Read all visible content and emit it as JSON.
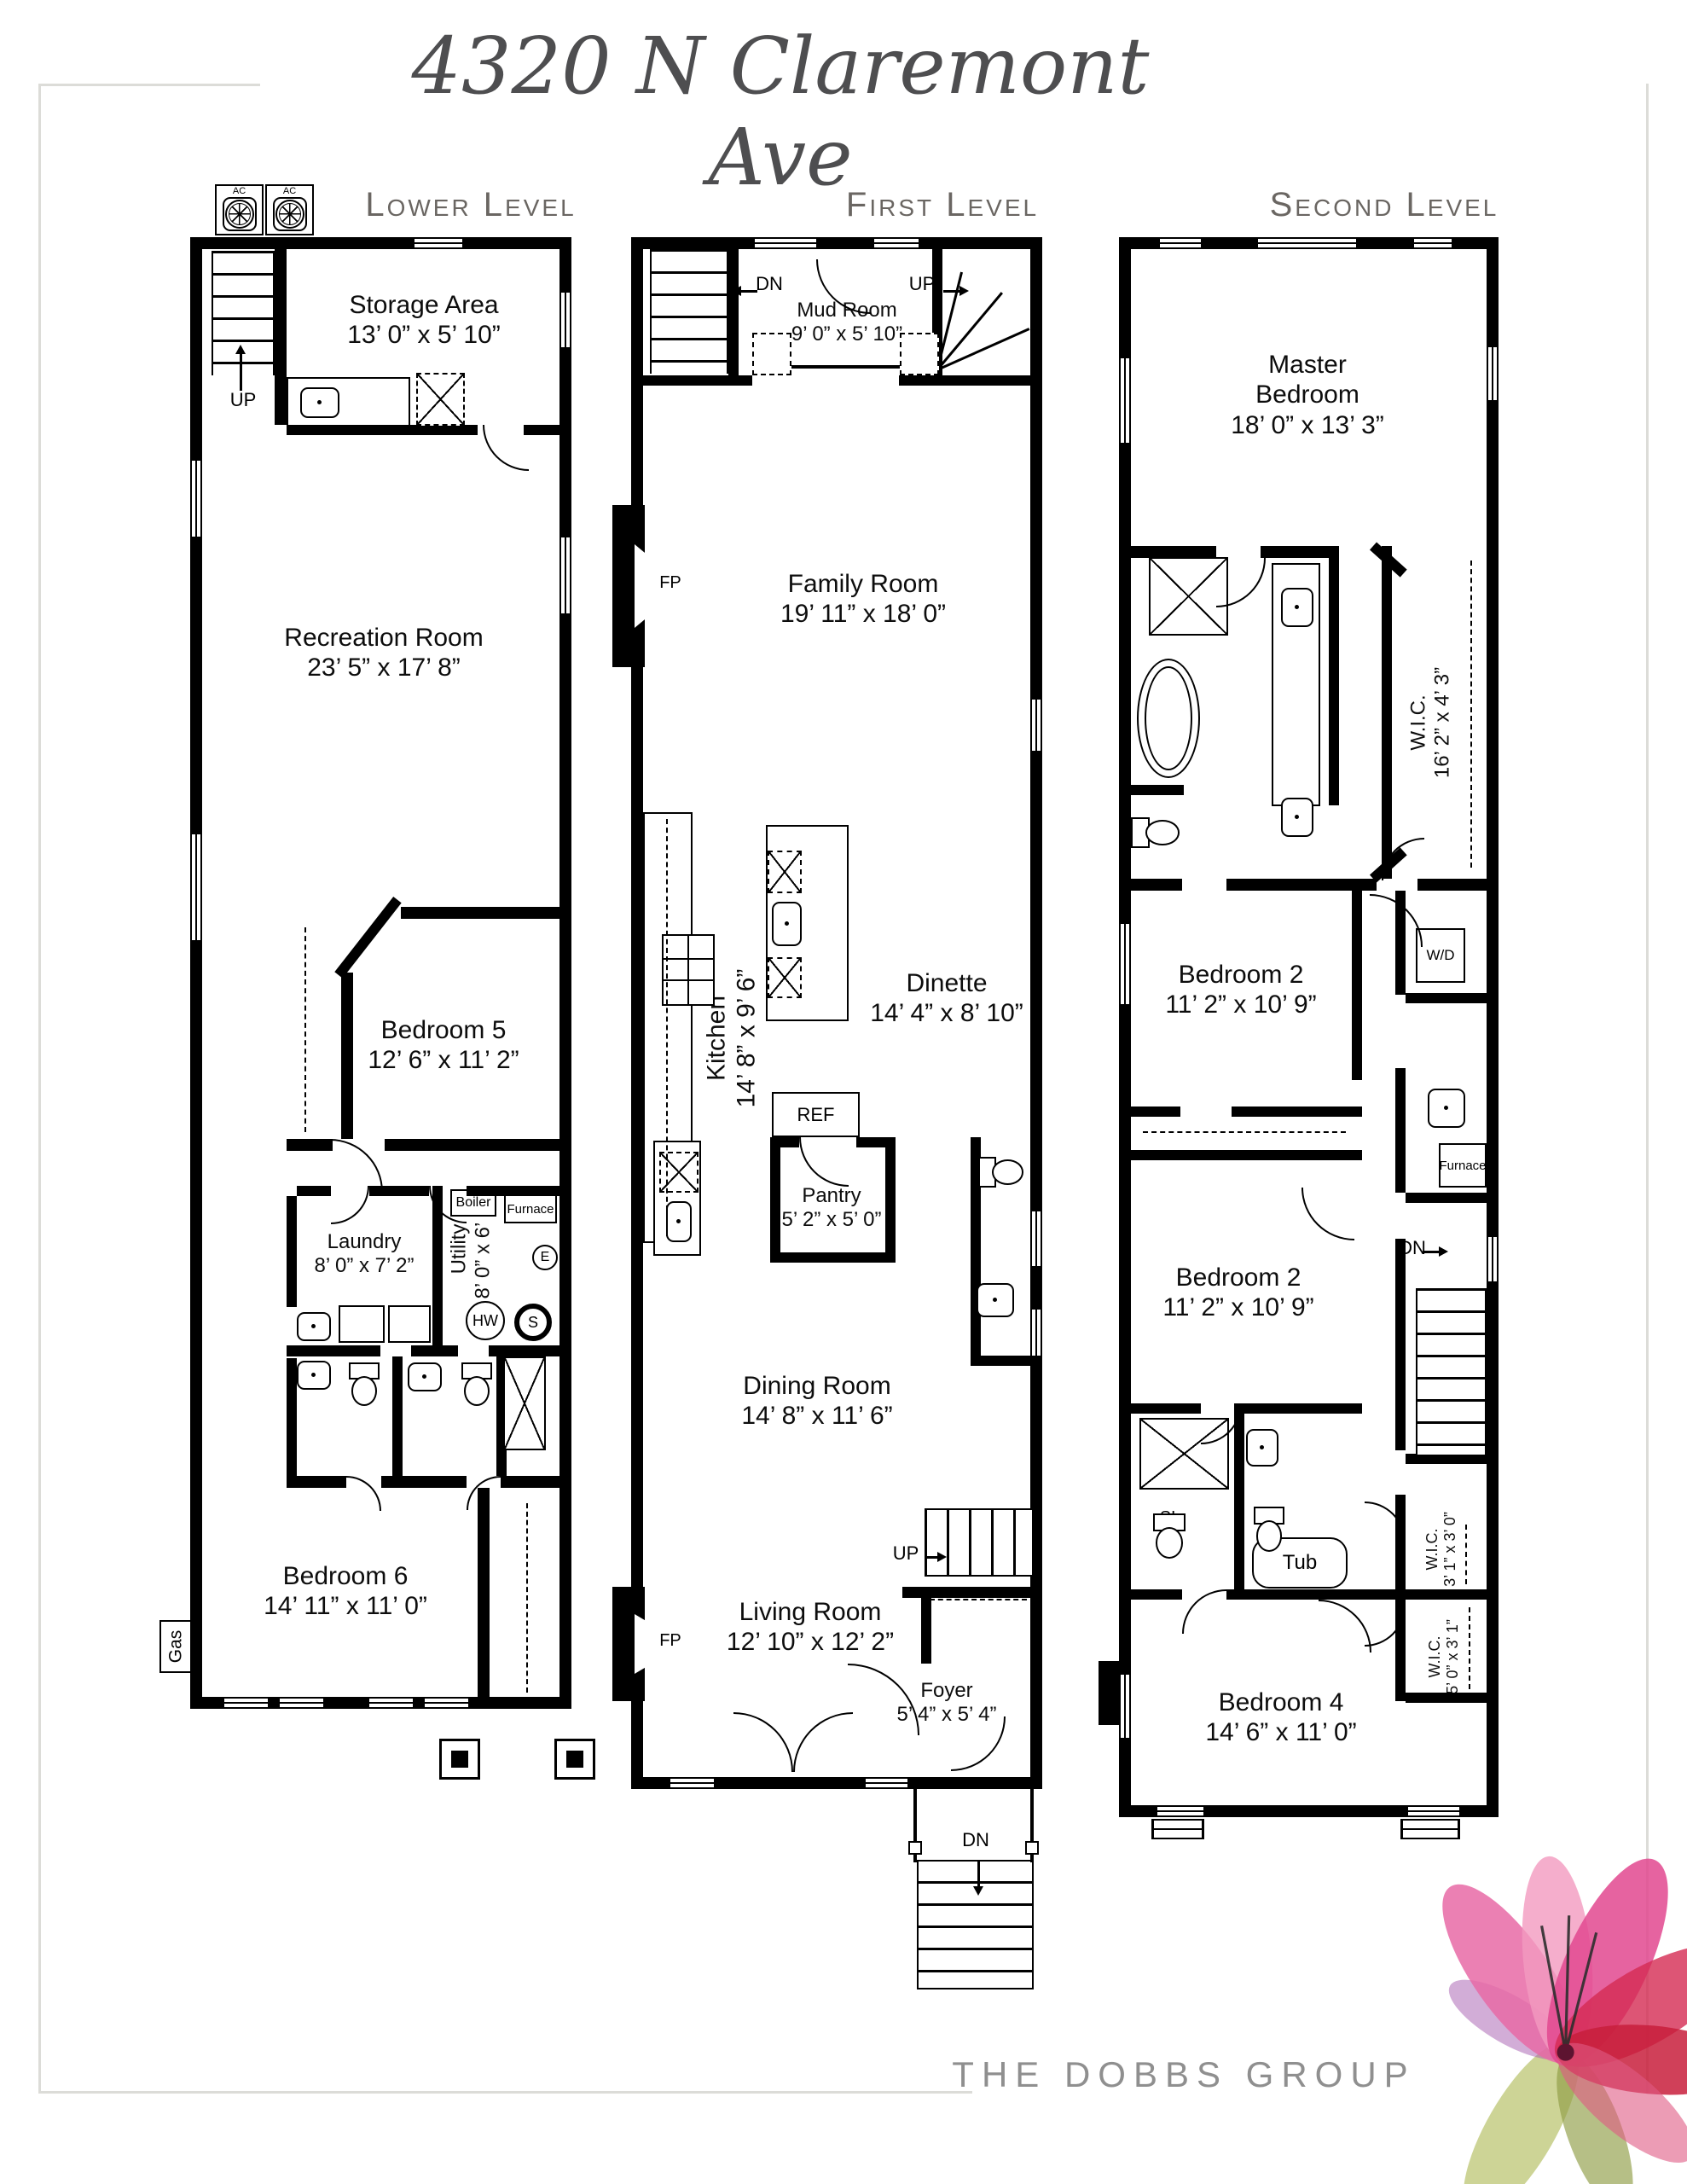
{
  "page": {
    "title": "4320 N Claremont Ave",
    "brand": "THE DOBBS GROUP"
  },
  "headers": {
    "lower": "Lower Level",
    "first": "First Level",
    "second": "Second Level"
  },
  "labels": {
    "up": "UP",
    "dn": "DN",
    "fp": "FP",
    "ref": "REF",
    "dish": "DISH",
    "mw": "MW",
    "wine": "WINE",
    "cooler": "COOLER",
    "ac": "AC",
    "gas": "Gas",
    "boiler": "Boiler",
    "furnace": "Furnace",
    "e": "E",
    "hw": "HW",
    "s": "S",
    "wd": "W/D",
    "sl": "SL",
    "tub": "Tub"
  },
  "lower": {
    "storage": {
      "name": "Storage Area",
      "dims": "13’ 0” x 5’ 10”"
    },
    "recreation": {
      "name": "Recreation Room",
      "dims": "23’ 5” x 17’ 8”"
    },
    "bedroom5": {
      "name": "Bedroom 5",
      "dims": "12’ 6” x 11’ 2”"
    },
    "laundry": {
      "name": "Laundry",
      "dims": "8’ 0” x 7’ 2”"
    },
    "utility": {
      "name": "Utility",
      "dims": "8’ 0” x 6’ 0”"
    },
    "bedroom6": {
      "name": "Bedroom 6",
      "dims": "14’ 11” x 11’ 0”"
    }
  },
  "first": {
    "mud": {
      "name": "Mud Room",
      "dims": "9’ 0” x 5’ 10”"
    },
    "family": {
      "name": "Family Room",
      "dims": "19’ 11” x 18’ 0”"
    },
    "kitchen": {
      "name": "Kitchen",
      "dims": "14’ 8” x 9’ 6”"
    },
    "dinette": {
      "name": "Dinette",
      "dims": "14’ 4” x 8’ 10”"
    },
    "pantry": {
      "name": "Pantry",
      "dims": "5’ 2” x 5’ 0”"
    },
    "dining": {
      "name": "Dining Room",
      "dims": "14’ 8” x 11’ 6”"
    },
    "living": {
      "name": "Living Room",
      "dims": "12’ 10” x 12’ 2”"
    },
    "foyer": {
      "name": "Foyer",
      "dims": "5’ 4” x 5’ 4”"
    }
  },
  "second": {
    "master": {
      "name": "Master Bedroom",
      "dims": "18’ 0” x 13’ 3”"
    },
    "wic_master": {
      "name": "W.I.C.",
      "dims": "16’ 2” x 4’ 3”"
    },
    "bedroom2a": {
      "name": "Bedroom 2",
      "dims": "11’ 2” x 10’ 9”"
    },
    "bedroom2b": {
      "name": "Bedroom 2",
      "dims": "11’ 2” x 10’ 9”"
    },
    "bedroom4": {
      "name": "Bedroom 4",
      "dims": "14’ 6” x 11’ 0”"
    },
    "wic3": {
      "name": "W.I.C.",
      "dims": "3’ 1” x 3’ 0”"
    },
    "wic5": {
      "name": "W.I.C.",
      "dims": "5’ 0” x 3’ 1”"
    }
  },
  "colors": {
    "wall": "#000000",
    "header_gray": "#6a6662",
    "title_gray": "#4e4e50",
    "brand_gray": "#8f8f8f",
    "flower_pink": "#e2488f",
    "flower_red": "#c81e3c",
    "flower_olive": "#9aa84f"
  }
}
